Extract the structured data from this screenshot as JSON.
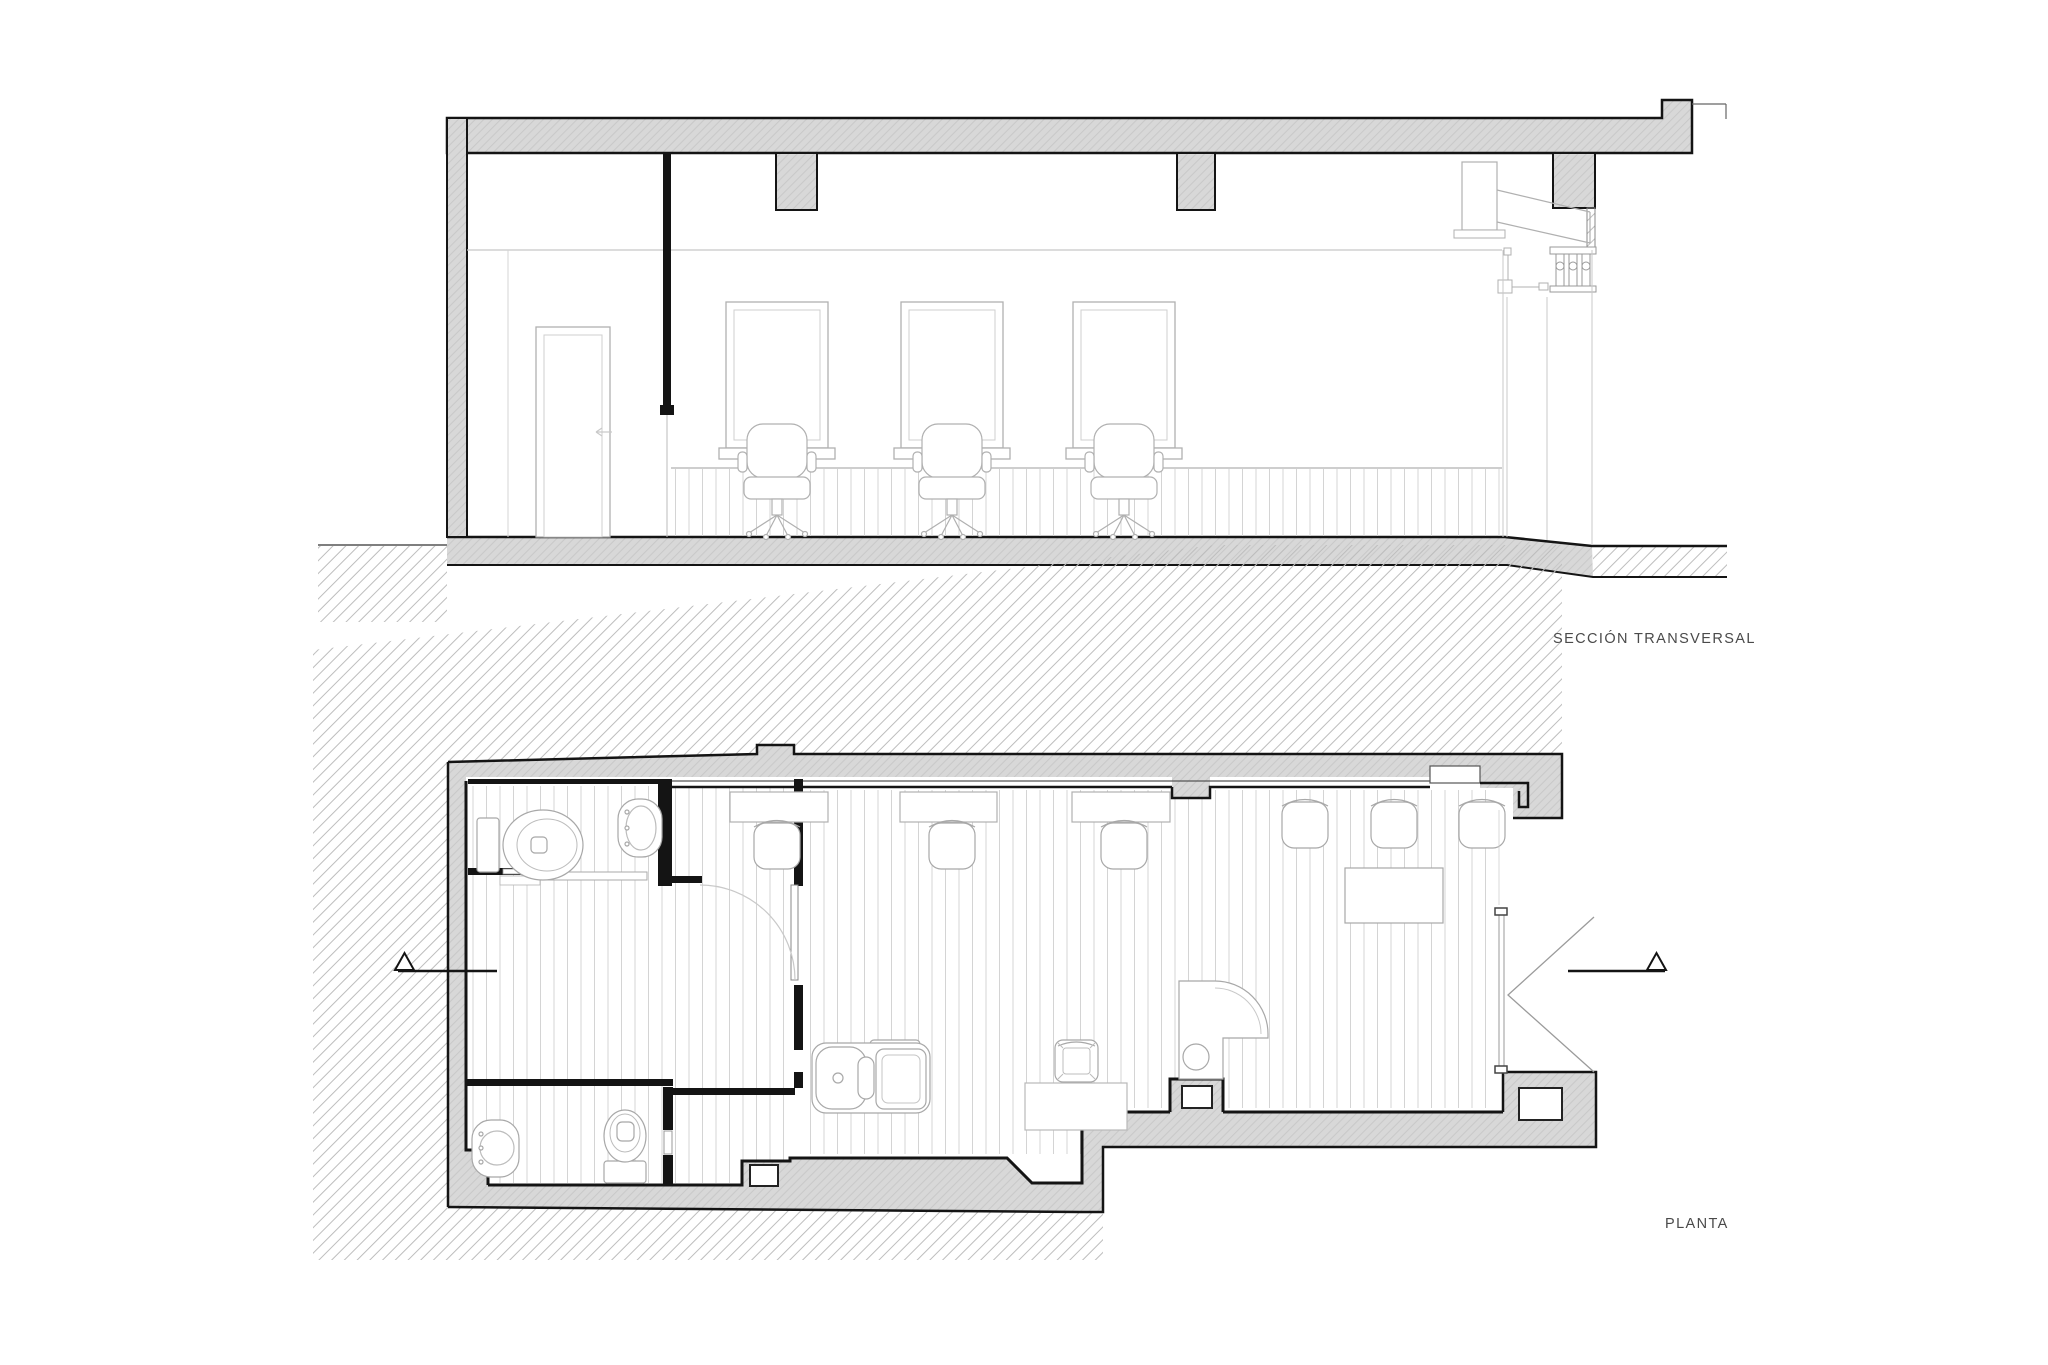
{
  "document": {
    "type": "architectural-drawing",
    "sheet_background": "#ffffff"
  },
  "labels": {
    "section": "SECCIÓN TRANSVERSAL",
    "plan": "PLANTA"
  },
  "palette": {
    "label-color": "#4a4a4a",
    "ink": "#141414",
    "wall-gray": "#d8d8d8",
    "hatch-gray": "#bdbdbd",
    "light-line": "#b0b0b0",
    "xlight-line": "#cfcfcf"
  },
  "drawings": [
    {
      "name": "cross-section",
      "label": "SECCIÓN TRANSVERSAL",
      "contents": [
        "roof slab with beams",
        "left bearing wall",
        "interior partition with door",
        "three mirror stations with styling chairs",
        "slat wainscot",
        "facade with cornice, balustrade and storefront",
        "floor slab and ground hatch"
      ]
    },
    {
      "name": "floor-plan",
      "label": "PLANTA",
      "contents": [
        "party-wall hatch",
        "two bathrooms with toilets and sinks",
        "three styling stations with chairs",
        "waiting chairs and table",
        "backwash shampoo unit",
        "reception desk with stool",
        "storefront entrance with open double door",
        "section cut marks"
      ]
    }
  ]
}
